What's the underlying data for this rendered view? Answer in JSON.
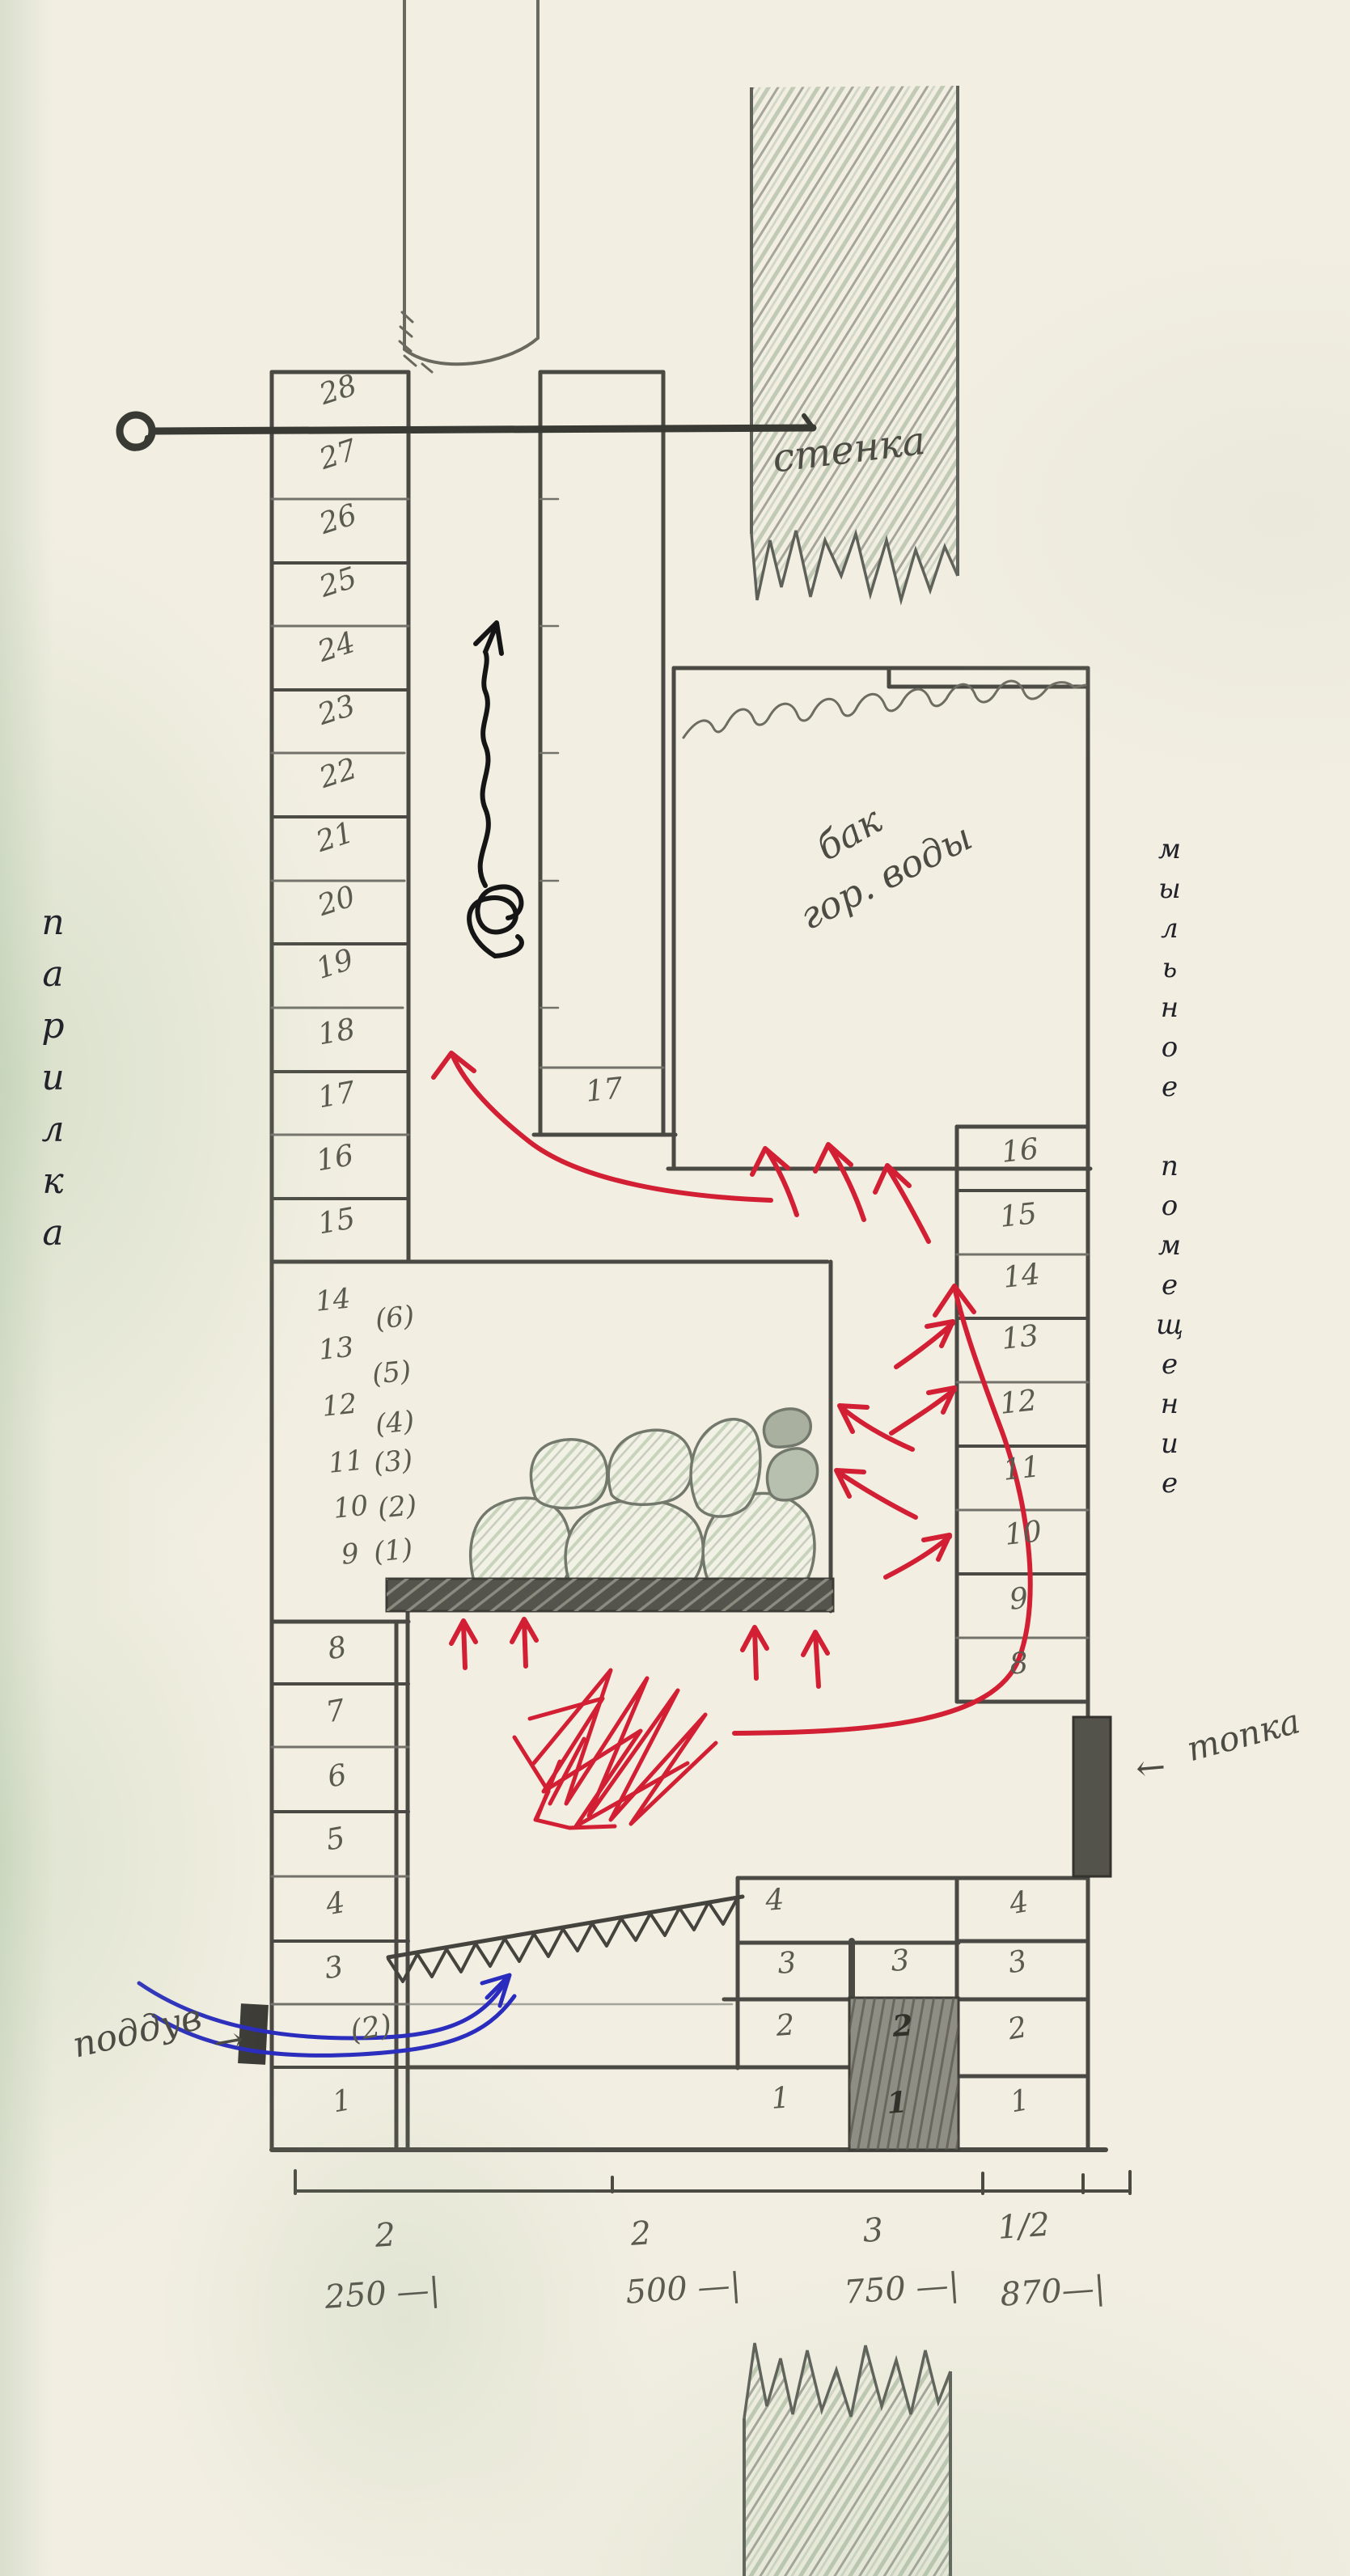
{
  "labels": {
    "left_room": "парилка",
    "right_room": "мыльное помещение",
    "wall": "стенка",
    "tank_line1": "бак",
    "tank_line2": "гор. воды",
    "firebox": "топка",
    "firebox_arrow": "←",
    "air_inlet": "поддув",
    "air_inlet_arrow": "→"
  },
  "courses": {
    "left_upper": [
      "28",
      "27",
      "26",
      "25",
      "24",
      "23",
      "22",
      "21",
      "20",
      "19",
      "18",
      "17",
      "16",
      "15"
    ],
    "inner": [
      "17"
    ],
    "right_upper": [
      "16",
      "15",
      "14",
      "13",
      "12",
      "11",
      "10",
      "9",
      "8"
    ],
    "left_lower": [
      "8",
      "7",
      "6",
      "5",
      "4",
      "3",
      "(2)",
      "1"
    ],
    "chamber": [
      "14",
      "13",
      "12",
      "11",
      "10",
      "9"
    ],
    "chamber_alt": [
      "(6)",
      "(5)",
      "(4)",
      "(3)",
      "(2)",
      "(1)"
    ],
    "bottom_mid": [
      "4",
      "3",
      "3",
      "2",
      "2",
      "1",
      "1"
    ],
    "bottom_right": [
      "4",
      "3",
      "2",
      "1"
    ]
  },
  "scale": {
    "counts": [
      "2",
      "2",
      "3",
      "1/2"
    ],
    "dims": [
      "250 —|",
      "500 —|",
      "750 —|",
      "870—|"
    ]
  },
  "colors": {
    "paper": "#f2efe2",
    "pencil": "#55544c",
    "graphite": "#5b5a50",
    "red": "#d21f33",
    "blue": "#2a2cbe",
    "ink": "#151515",
    "door_dark": "#3c3b36",
    "steel": "#55544c",
    "wall_hatch_green": "#96ab90"
  }
}
